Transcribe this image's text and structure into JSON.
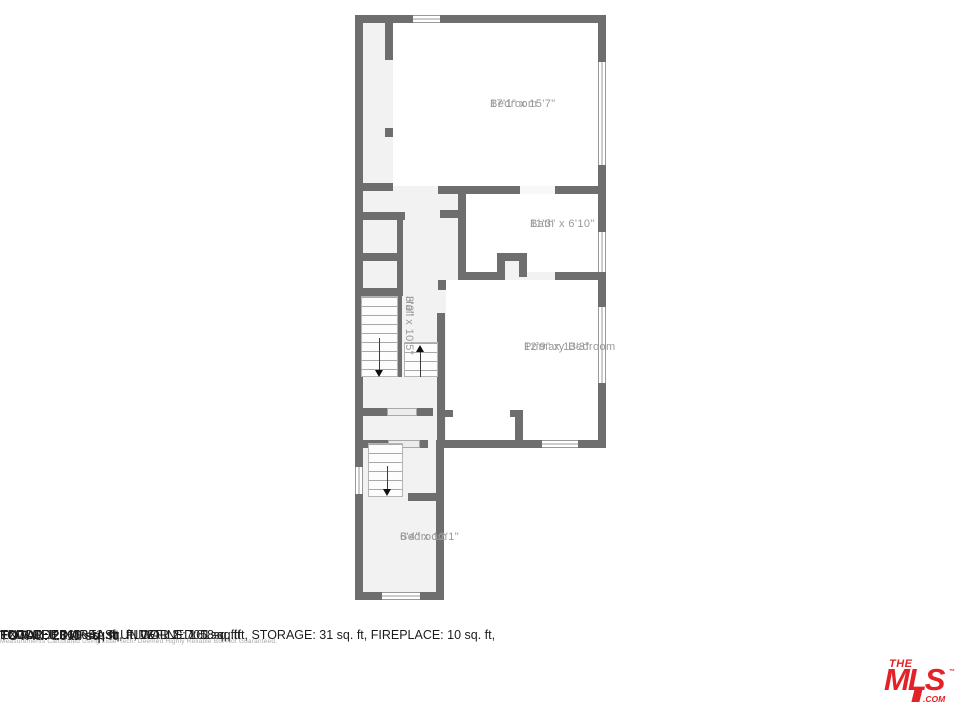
{
  "floorplan": {
    "rooms": {
      "bedroom_top": {
        "name": "Bedroom",
        "dims": "17'1\" x 15'7\""
      },
      "bath": {
        "name": "Bath",
        "dims": "11'3\" x 6'10\""
      },
      "hall": {
        "name": "Hall",
        "dims": "3'0\" x 10'5\""
      },
      "primary_bedroom": {
        "name": "Primary Bedroom",
        "dims": "12'9\" x 13'3\""
      },
      "bedroom_bottom": {
        "name": "Bedroom",
        "dims": "6'4\" x 12'1\""
      }
    },
    "colors": {
      "wall": "#6e6e6e",
      "room_fill": "#ffffff",
      "corridor_fill": "#f2f2f2",
      "label_text": "#9a9a9a"
    }
  },
  "summary": {
    "total": "TOTAL: 2311 sq. ft",
    "floors": "FLOOR 1: 1606 sq. ft, FLOOR 2: 705 sq. ft",
    "excluded_line1": "EXCLUDED AREAS: UNDEFINED: 18 sq. ft, STORAGE: 31 sq. ft, FIREPLACE: 10 sq. ft,",
    "excluded_line2": "LOW CEILING: 41 sq. ft, WALLS: 161 sq. ft",
    "disclaimer": "Measurements Calculated Using Lidar Tech. Deemed Highly Reliable But Not Guaranteed."
  },
  "logo": {
    "the": "THE",
    "mls": "MLS",
    "tm": "™",
    "com": ".COM",
    "color": "#e32228"
  }
}
